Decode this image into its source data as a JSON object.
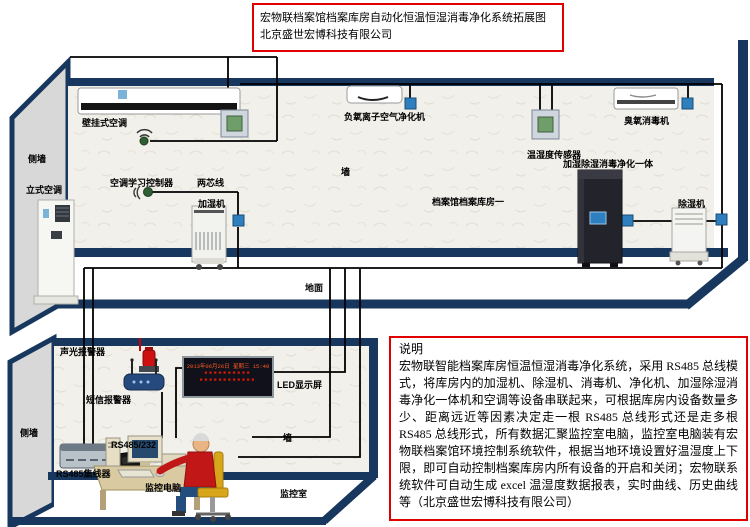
{
  "title_box": {
    "line1": "宏物联档案馆档案库房自动化恒温恒湿消毒净化系统拓展图",
    "line2": "北京盛世宏博科技有限公司"
  },
  "archive_room": {
    "name_label": "档案馆档案库房一",
    "wall_label": "墙",
    "side_wall_label": "侧墙",
    "floor_label": "地面",
    "devices": {
      "wall_ac": "壁挂式空调",
      "ac_learn_controller": "空调学习控制器",
      "two_core_wire": "两芯线",
      "humidifier": "加湿机",
      "floor_ac": "立式空调",
      "neg_ion_purifier": "负氧离子空气净化机",
      "temp_humidity_sensor": "温湿度传感器",
      "ozone_sterilizer": "臭氧消毒机",
      "all_in_one": "加湿除湿消毒净化一体",
      "dehumidifier": "除湿机"
    }
  },
  "monitor_room": {
    "name_label": "监控室",
    "wall_label": "墙",
    "side_wall_label": "侧墙",
    "devices": {
      "sound_light_alarm": "声光报警器",
      "sms_alarm": "短信报警器",
      "led_screen": "LED显示屏",
      "rs485_232": "RS485/232",
      "rs485_hub": "RS485集线器",
      "monitor_pc": "监控电脑"
    },
    "led_display": {
      "line1": "2013年06月26日 星期三 15:40",
      "line2": "■■■■■■■■■■",
      "line3": "■■■■■■■■■■■■"
    }
  },
  "note_box": {
    "heading": "说明",
    "body": "宏物联智能档案库房恒温恒湿消毒净化系统，采用 RS485 总线模式，将库房内的加湿机、除湿机、消毒机、净化机、加湿除湿消毒净化一体机和空调等设备串联起来，可根据库房内设备数量多少、距离远近等因素决定走一根 RS485 总线形式还是走多根 RS485 总线形式，所有数据汇聚监控室电脑，监控室电脑装有宏物联档案馆环境控制系统软件，根据当地环境设置好温湿度上下限，即可自动控制档案库房内所有设备的开启和关闭；宏物联系统软件可自动生成 excel 温湿度数据报表，实时曲线、历史曲线等（北京盛世宏博科技有限公司）"
  },
  "colors": {
    "accent_red": "#e00000",
    "navy": "#17375e",
    "connector_blue": "#2f7fbe",
    "alarm_red": "#cf1010",
    "led_red": "#e01800",
    "chair_yellow": "#d7a61b"
  }
}
